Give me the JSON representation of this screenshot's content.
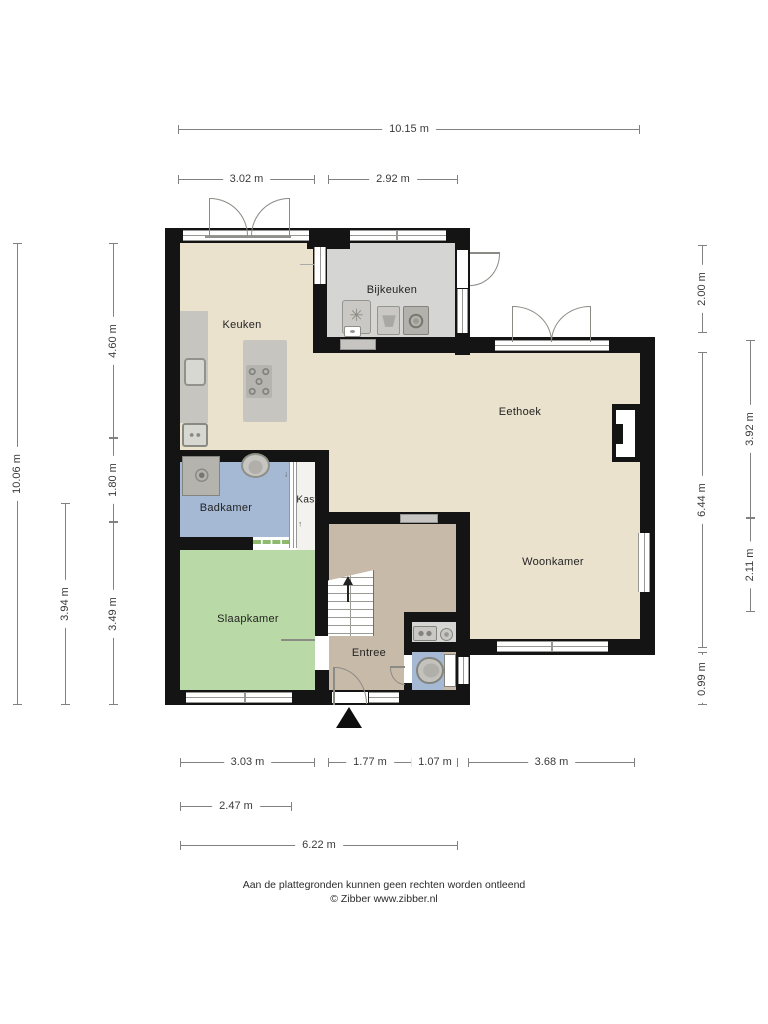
{
  "plan": {
    "rooms": {
      "keuken": {
        "label": "Keuken"
      },
      "bijkeuken": {
        "label": "Bijkeuken"
      },
      "eethoek": {
        "label": "Eethoek"
      },
      "woonkamer": {
        "label": "Woonkamer"
      },
      "badkamer": {
        "label": "Badkamer"
      },
      "kast": {
        "label": "Kast"
      },
      "slaapkamer": {
        "label": "Slaapkamer"
      },
      "entree": {
        "label": "Entree"
      }
    },
    "icons": {
      "boiler_fan_glyph": "✳",
      "kast_arrow_down_glyph": "↓",
      "kast_arrow_up_glyph": "↑"
    },
    "colors": {
      "floor_beige": "#eae2cd",
      "floor_gray": "#d5d5d3",
      "floor_blue": "#a5b8d4",
      "floor_green": "#b9daa6",
      "floor_tan": "#c8baa8",
      "floor_white": "#f3f2ef",
      "wall": "#141414",
      "fixture_gray": "#c6c5c0",
      "dashed_opening": "#8cbb6d"
    }
  },
  "dimensions": {
    "top": {
      "total": "10.15 m",
      "left": "3.02 m",
      "right": "2.92 m"
    },
    "left": {
      "total": "10.06 m",
      "upper": "4.60 m",
      "middle": "1.80 m",
      "lower": "3.49 m",
      "outer_lower": "3.94 m"
    },
    "right": {
      "inner_upper": "2.00 m",
      "inner_middle": "6.44 m",
      "inner_lower": "0.99 m",
      "outer_upper": "3.92 m",
      "outer_lower": "2.11 m"
    },
    "bottom": {
      "seg1": "3.03 m",
      "seg2": "1.77 m",
      "seg3": "1.07 m",
      "seg4": "3.68 m",
      "row2": "2.47 m",
      "row3": "6.22 m"
    }
  },
  "footer": {
    "disclaimer": "Aan de plattegronden kunnen geen rechten worden ontleend",
    "copyright": "© Zibber www.zibber.nl"
  }
}
